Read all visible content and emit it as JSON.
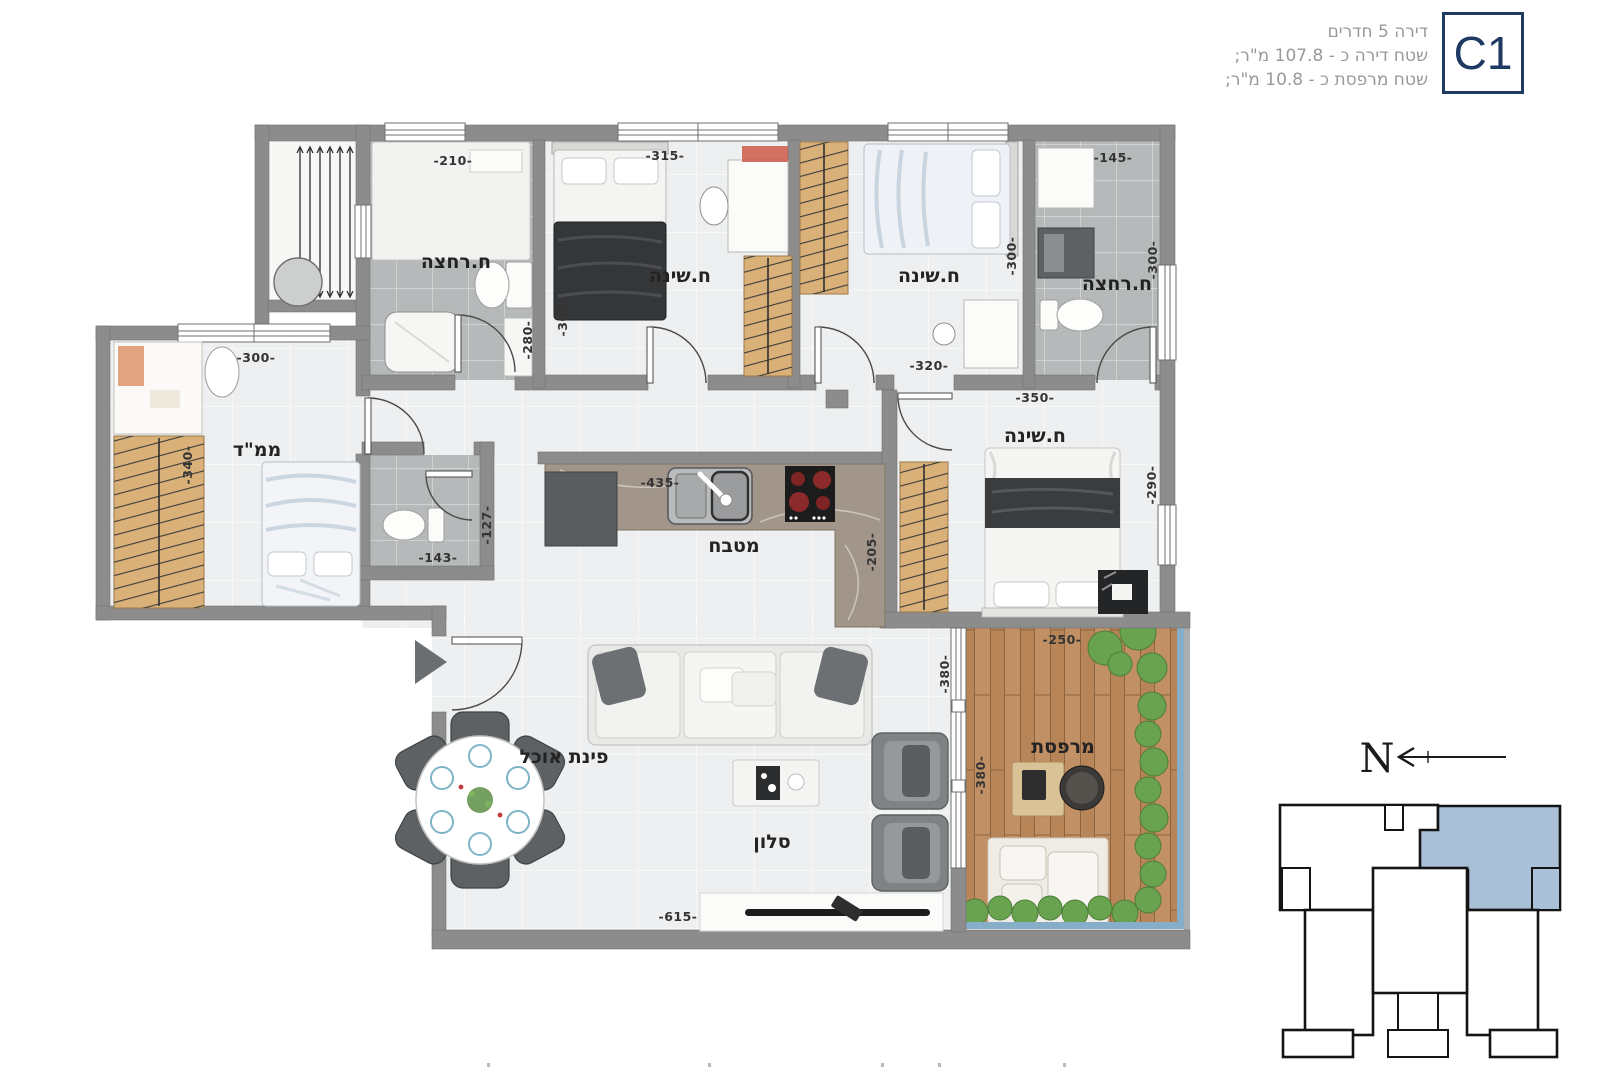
{
  "header": {
    "line1": "דירה 5 חדרים",
    "line2": "שטח דירה כ - 107.8 מ\"ר;",
    "line3": "שטח מרפסת כ - 10.8 מ\"ר;",
    "unit": "C1"
  },
  "labels": {
    "bath1": "ח.רחצה",
    "bed1": "ח.שינה",
    "bed2": "ח.שינה",
    "bath2": "ח.רחצה",
    "mamad": "ממ\"ד",
    "kitchen": "מטבח",
    "dining": "פינת אוכל",
    "living": "סלון",
    "master": "ח.שינה",
    "balcony": "מרפסת"
  },
  "dims": {
    "bath1_w": "-210-",
    "bed1_w": "-315-",
    "bath2_w": "-145-",
    "bed1_h": "-300-",
    "hall_h": "-280-",
    "bed2_h": "-300-",
    "bath2_h": "-300-",
    "bed2_w": "-320-",
    "master_w": "-350-",
    "mamad_w": "-300-",
    "mamad_h": "-340-",
    "wc_w": "-143-",
    "wc_h": "-127-",
    "kitchen_w": "-435-",
    "kitchen_h": "-205-",
    "master_h": "-290-",
    "balcony_w": "-250-",
    "living_h": "-380-",
    "balcony_h": "-380-",
    "living_w": "-615-"
  },
  "compass": {
    "north": "N"
  },
  "colors": {
    "wall": "#8c8c8c",
    "floor": "#edeff0",
    "bath_tile": "#b6b9ba",
    "wood": "#d9b078",
    "deck": "#c19064",
    "plant": "#6aa34f",
    "railing_blue": "#86aec9",
    "accent_navy": "#1e3a63",
    "keyplan_unit": "#a9c0d6"
  }
}
